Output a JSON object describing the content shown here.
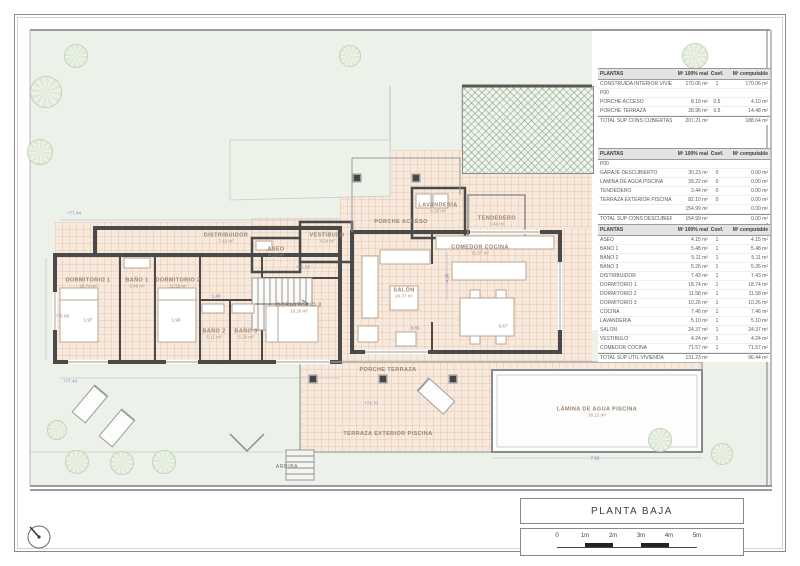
{
  "palette": {
    "garden_green": "#ecf2e9",
    "paving_peach": "#f7e9dc",
    "wall_gray": "#4a4a4a",
    "dimension_purple": "#7d76b5",
    "label_brown": "#97826f"
  },
  "tables": [
    {
      "title": "PLANTAS",
      "headers": [
        "M² 100% real",
        "Coef.",
        "M² computable"
      ],
      "rows": [
        {
          "name": "CONSTRUIDA INTERIOR VIVIENDA",
          "real": "170.06 m²",
          "coef": "1",
          "comp": "170.06 m²"
        },
        {
          "name": "P00",
          "real": "",
          "coef": "",
          "comp": ""
        },
        {
          "name": "PORCHE ACCESO",
          "real": "8.19 m²",
          "coef": "0.5",
          "comp": "4.10 m²"
        },
        {
          "name": "PORCHE TERRAZA",
          "real": "28.96 m²",
          "coef": "0.5",
          "comp": "14.48 m²"
        },
        {
          "name": "TOTAL SUP CONS CUBIERTAS",
          "real": "207.21 m²",
          "coef": "",
          "comp": "188.64 m²",
          "total": true
        }
      ]
    },
    {
      "title": "PLANTAS",
      "headers": [
        "M² 100% real",
        "Coef.",
        "M² computable"
      ],
      "rows": [
        {
          "name": "P00",
          "real": "",
          "coef": "",
          "comp": ""
        },
        {
          "name": "GARAJE DESCUBIERTO",
          "real": "30.23 m²",
          "coef": "0",
          "comp": "0.00 m²"
        },
        {
          "name": "LÁMINA DE AGUA PISCINA",
          "real": "39.22 m²",
          "coef": "0",
          "comp": "0.00 m²"
        },
        {
          "name": "TENDEDERO",
          "real": "3.44 m²",
          "coef": "0",
          "comp": "0.00 m²"
        },
        {
          "name": "TERRAZA EXTERIOR PISCINA",
          "real": "82.10 m²",
          "coef": "0",
          "comp": "0.00 m²"
        },
        {
          "name": "",
          "real": "154.99 m²",
          "coef": "",
          "comp": "0.00 m²"
        },
        {
          "name": "TOTAL SUP CONS DESCUBIERTAS",
          "real": "154.99 m²",
          "coef": "",
          "comp": "0.00 m²",
          "total": true
        }
      ]
    },
    {
      "title": "PLANTAS",
      "headers": [
        "M² 100% real",
        "Coef.",
        "M² computable"
      ],
      "rows": [
        {
          "name": "ASEO",
          "real": "4.15 m²",
          "coef": "1",
          "comp": "4.15 m²"
        },
        {
          "name": "BAÑO 1",
          "real": "5.48 m²",
          "coef": "1",
          "comp": "5.48 m²"
        },
        {
          "name": "BAÑO 2",
          "real": "5.11 m²",
          "coef": "1",
          "comp": "5.11 m²"
        },
        {
          "name": "BAÑO 3",
          "real": "5.26 m²",
          "coef": "1",
          "comp": "5.26 m²"
        },
        {
          "name": "DISTRIBUIDOR",
          "real": "7.43 m²",
          "coef": "1",
          "comp": "7.43 m²"
        },
        {
          "name": "DORMITORIO 1",
          "real": "18.74 m²",
          "coef": "1",
          "comp": "18.74 m²"
        },
        {
          "name": "DORMITORIO 2",
          "real": "11.58 m²",
          "coef": "1",
          "comp": "11.58 m²"
        },
        {
          "name": "DORMITORIO 3",
          "real": "10.26 m²",
          "coef": "1",
          "comp": "10.26 m²"
        },
        {
          "name": "COCINA",
          "real": "7.46 m²",
          "coef": "1",
          "comp": "7.46 m²"
        },
        {
          "name": "LAVANDERÍA",
          "real": "5.10 m²",
          "coef": "1",
          "comp": "5.10 m²"
        },
        {
          "name": "SALÓN",
          "real": "24.37 m²",
          "coef": "1",
          "comp": "24.37 m²"
        },
        {
          "name": "VESTÍBULO",
          "real": "4.24 m²",
          "coef": "1",
          "comp": "4.24 m²"
        },
        {
          "name": "COMEDOR COCINA",
          "real": "71.57 m²",
          "coef": "1",
          "comp": "71.57 m²"
        },
        {
          "name": "TOTAL SUP ÚTIL VIVIENDA",
          "real": "131.23 m²",
          "coef": "",
          "comp": "96.44 m²",
          "total": true
        }
      ]
    }
  ],
  "rooms": [
    {
      "name": "DORMITORIO 1",
      "area": "18.74 m²",
      "x": 88,
      "y": 283
    },
    {
      "name": "BAÑO 1",
      "area": "5.48 m²",
      "x": 137,
      "y": 283
    },
    {
      "name": "DORMITORIO 2",
      "area": "11.58 m²",
      "x": 178,
      "y": 283
    },
    {
      "name": "BAÑO 2",
      "area": "5.11 m²",
      "x": 214,
      "y": 334
    },
    {
      "name": "BAÑO 3",
      "area": "5.26 m²",
      "x": 246,
      "y": 334
    },
    {
      "name": "DORMITORIO 3",
      "area": "10.26 m²",
      "x": 299,
      "y": 308
    },
    {
      "name": "DISTRIBUIDOR",
      "area": "7.43 m²",
      "x": 226,
      "y": 238
    },
    {
      "name": "ASEO",
      "area": "4.15 m²",
      "x": 276,
      "y": 252
    },
    {
      "name": "VESTÍBULO",
      "area": "4.24 m²",
      "x": 327,
      "y": 238
    },
    {
      "name": "PORCHE ACCESO",
      "area": "",
      "x": 401,
      "y": 222
    },
    {
      "name": "LAVANDERÍA",
      "area": "5.10 m²",
      "x": 438,
      "y": 208
    },
    {
      "name": "TENDEDERO",
      "area": "3.44 m²",
      "x": 497,
      "y": 221
    },
    {
      "name": "SALÓN",
      "area": "24.37 m²",
      "x": 404,
      "y": 293
    },
    {
      "name": "COMEDOR COCINA",
      "area": "71.57 m²",
      "x": 480,
      "y": 250
    },
    {
      "name": "PORCHE TERRAZA",
      "area": "",
      "x": 388,
      "y": 370
    },
    {
      "name": "TERRAZA EXTERIOR PISCINA",
      "area": "",
      "x": 388,
      "y": 434
    },
    {
      "name": "LÁMINA DE AGUA PISCINA",
      "area": "39.22 m²",
      "x": 597,
      "y": 412
    }
  ],
  "annotations": [
    {
      "t": "+77.44",
      "x": 74,
      "y": 213,
      "cls": "elev"
    },
    {
      "t": "+70.98",
      "x": 62,
      "y": 316,
      "cls": "elev"
    },
    {
      "t": "+71.58",
      "x": 303,
      "y": 267,
      "cls": "elev"
    },
    {
      "t": "+74.70",
      "x": 371,
      "y": 403,
      "cls": "elev"
    },
    {
      "t": "+77.44",
      "x": 70,
      "y": 381,
      "cls": "elev"
    },
    {
      "t": "1.97",
      "x": 88,
      "y": 320
    },
    {
      "t": "1.90",
      "x": 176,
      "y": 320
    },
    {
      "t": "1.40",
      "x": 216,
      "y": 296
    },
    {
      "t": "4.38",
      "x": 447,
      "y": 278,
      "rot": -90
    },
    {
      "t": "6.67",
      "x": 503,
      "y": 326
    },
    {
      "t": "0.86",
      "x": 415,
      "y": 328
    },
    {
      "t": "7.82",
      "x": 595,
      "y": 458
    },
    {
      "t": "ARRIBA",
      "x": 287,
      "y": 467,
      "cls": "small"
    }
  ],
  "trees": [
    {
      "x": 46,
      "y": 92,
      "r": 15
    },
    {
      "x": 40,
      "y": 152,
      "r": 12
    },
    {
      "x": 76,
      "y": 56,
      "r": 11
    },
    {
      "x": 350,
      "y": 56,
      "r": 10
    },
    {
      "x": 695,
      "y": 56,
      "r": 12
    },
    {
      "x": 748,
      "y": 92,
      "r": 10
    },
    {
      "x": 645,
      "y": 278,
      "r": 13
    },
    {
      "x": 702,
      "y": 250,
      "r": 11
    },
    {
      "x": 740,
      "y": 302,
      "r": 11
    },
    {
      "x": 660,
      "y": 440,
      "r": 11
    },
    {
      "x": 722,
      "y": 454,
      "r": 10
    },
    {
      "x": 77,
      "y": 462,
      "r": 11
    },
    {
      "x": 122,
      "y": 463,
      "r": 11
    },
    {
      "x": 164,
      "y": 462,
      "r": 11
    },
    {
      "x": 57,
      "y": 430,
      "r": 9
    }
  ],
  "columns": [
    {
      "x": 313,
      "y": 379
    },
    {
      "x": 383,
      "y": 379
    },
    {
      "x": 453,
      "y": 379
    },
    {
      "x": 357,
      "y": 178
    },
    {
      "x": 416,
      "y": 178
    }
  ],
  "loungers": [
    {
      "x": 90,
      "y": 404,
      "rot": 40
    },
    {
      "x": 117,
      "y": 428,
      "rot": 40
    },
    {
      "x": 436,
      "y": 396,
      "rot": -48
    }
  ],
  "titleblock": {
    "title": "PLANTA BAJA",
    "scale_ticks": [
      "0",
      "1m",
      "2m",
      "3m",
      "4m",
      "5m"
    ]
  }
}
